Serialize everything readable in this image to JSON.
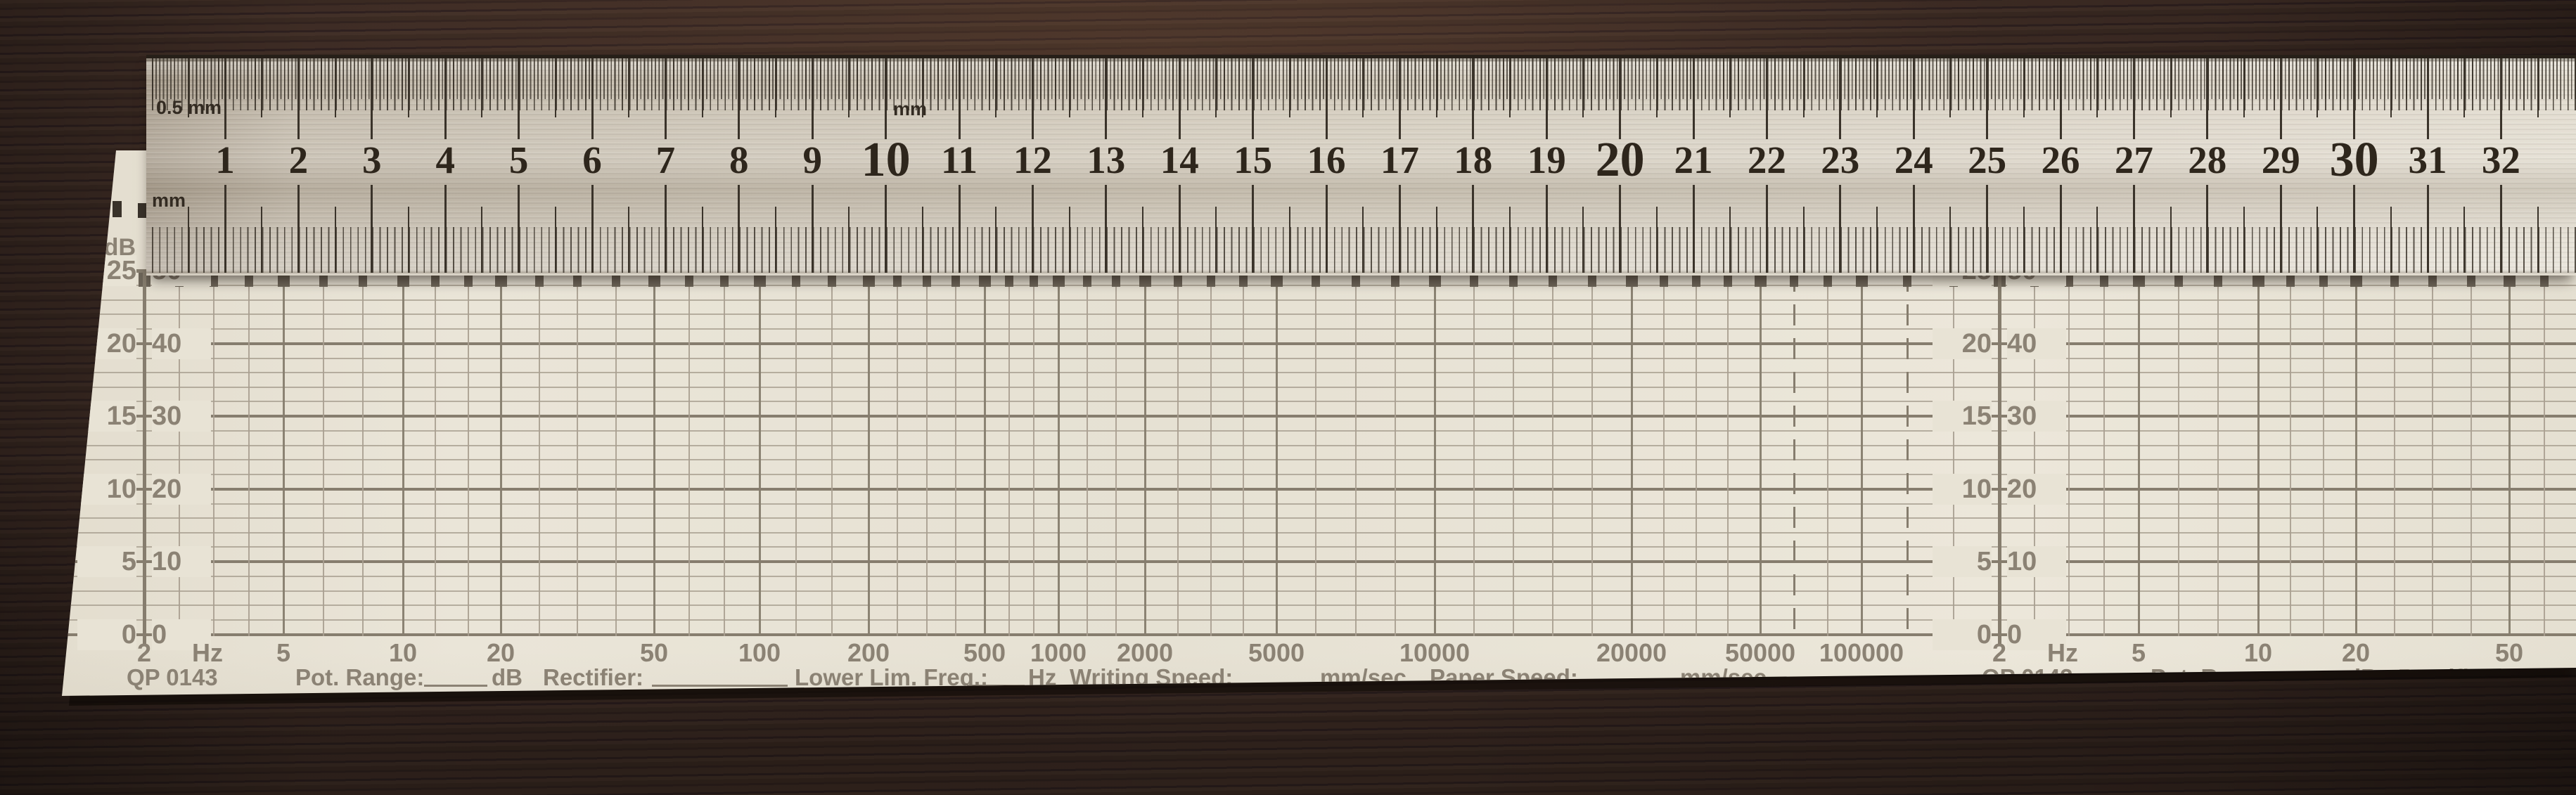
{
  "background": {
    "surface": "dark-brown wooden table",
    "wood_color": "#3a2a22"
  },
  "ruler": {
    "kind": "steel ruler",
    "top_scale_label": "0.5 mm",
    "top_center_label": "mm",
    "bottom_scale_label": "mm",
    "numbers": [
      1,
      2,
      3,
      4,
      5,
      6,
      7,
      8,
      9,
      10,
      11,
      12,
      13,
      14,
      15,
      16,
      17,
      18,
      19,
      20,
      21,
      22,
      23,
      24,
      25,
      26,
      27,
      28,
      29,
      30,
      31,
      32
    ],
    "emphasized": [
      10,
      20,
      30
    ],
    "marking_color": "#32291f"
  },
  "chart_paper": {
    "model": "QP 0143",
    "db_header": "dB",
    "db_rows": [
      {
        "left": "25",
        "right": "50"
      },
      {
        "left": "20",
        "right": "40"
      },
      {
        "left": "15",
        "right": "30"
      },
      {
        "left": "10",
        "right": "20"
      },
      {
        "left": "5",
        "right": "10"
      },
      {
        "left": "0",
        "right": "0"
      }
    ],
    "freq_labels": [
      "2",
      "5",
      "10",
      "20",
      "50",
      "100",
      "200",
      "500",
      "1000",
      "2000",
      "5000",
      "10000",
      "20000",
      "50000",
      "100000"
    ],
    "freq_unit": "Hz",
    "form": {
      "pot_range": "Pot. Range:",
      "pot_range_unit": "dB",
      "rectifier": "Rectifier:",
      "lower_lim_freq": "Lower Lim. Freq.:",
      "lower_lim_freq_unit": "Hz",
      "writing_speed": "Writing Speed:",
      "writing_speed_unit": "mm/sec.",
      "paper_speed": "Paper Speed:",
      "paper_speed_unit": "mm/sec."
    },
    "sections": 2,
    "colors": {
      "paper": "#e9e4d7",
      "paper_patch": "#e8e3d5",
      "ink": "#8b8274",
      "grid_major": "#867d6e",
      "grid_minor": "#a89f90",
      "fringe": "#6e665a"
    }
  }
}
